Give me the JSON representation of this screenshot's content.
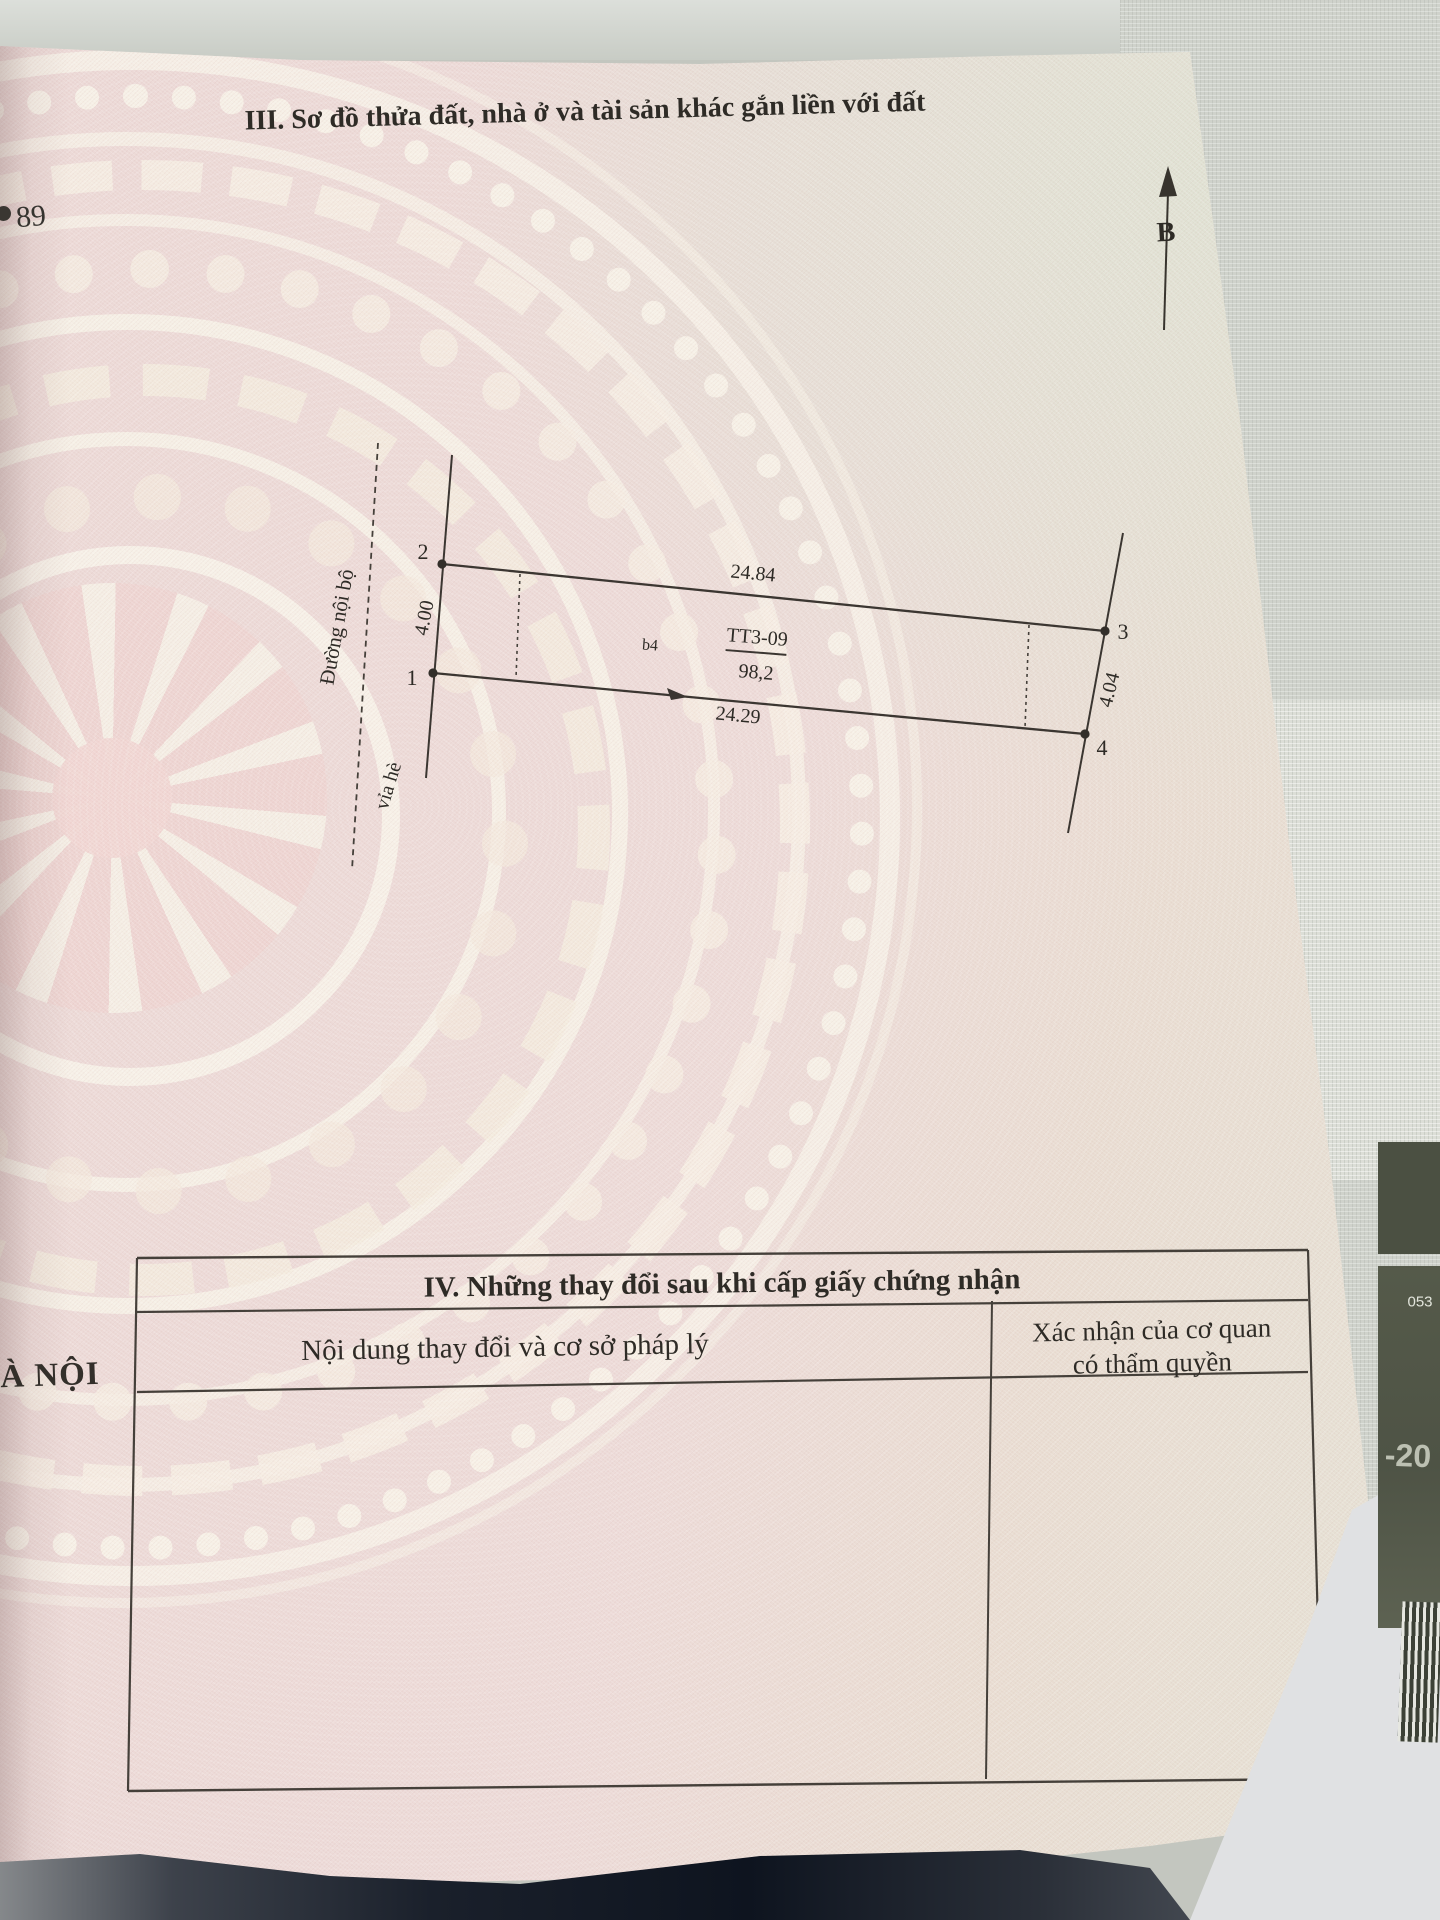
{
  "document": {
    "margin_number": "89",
    "left_edge_text": "À NỘI",
    "section3": {
      "title": "III. Sơ đồ thửa đất, nhà ở và tài sản khác gắn liền với đất",
      "north_label": "B"
    },
    "diagram": {
      "plot_code": "TT3-09",
      "area": "98,2",
      "block_label": "b4",
      "road_label": "Đường nội bộ",
      "sidewalk_label": "vỉa hè",
      "point_labels": {
        "p1": "1",
        "p2": "2",
        "p3": "3",
        "p4": "4"
      },
      "dimensions": {
        "top": "24.84",
        "bottom": "24.29",
        "left": "4.00",
        "right": "4.04"
      }
    },
    "section4": {
      "title": "IV. Những thay đổi sau khi cấp giấy chứng nhận",
      "columns": [
        {
          "header": "Nội dung thay đổi và cơ sở pháp lý"
        },
        {
          "header_line1": "Xác nhận của cơ quan",
          "header_line2": "có thẩm quyền"
        }
      ]
    },
    "sticker": {
      "line1": "-20",
      "line2": "053"
    }
  }
}
